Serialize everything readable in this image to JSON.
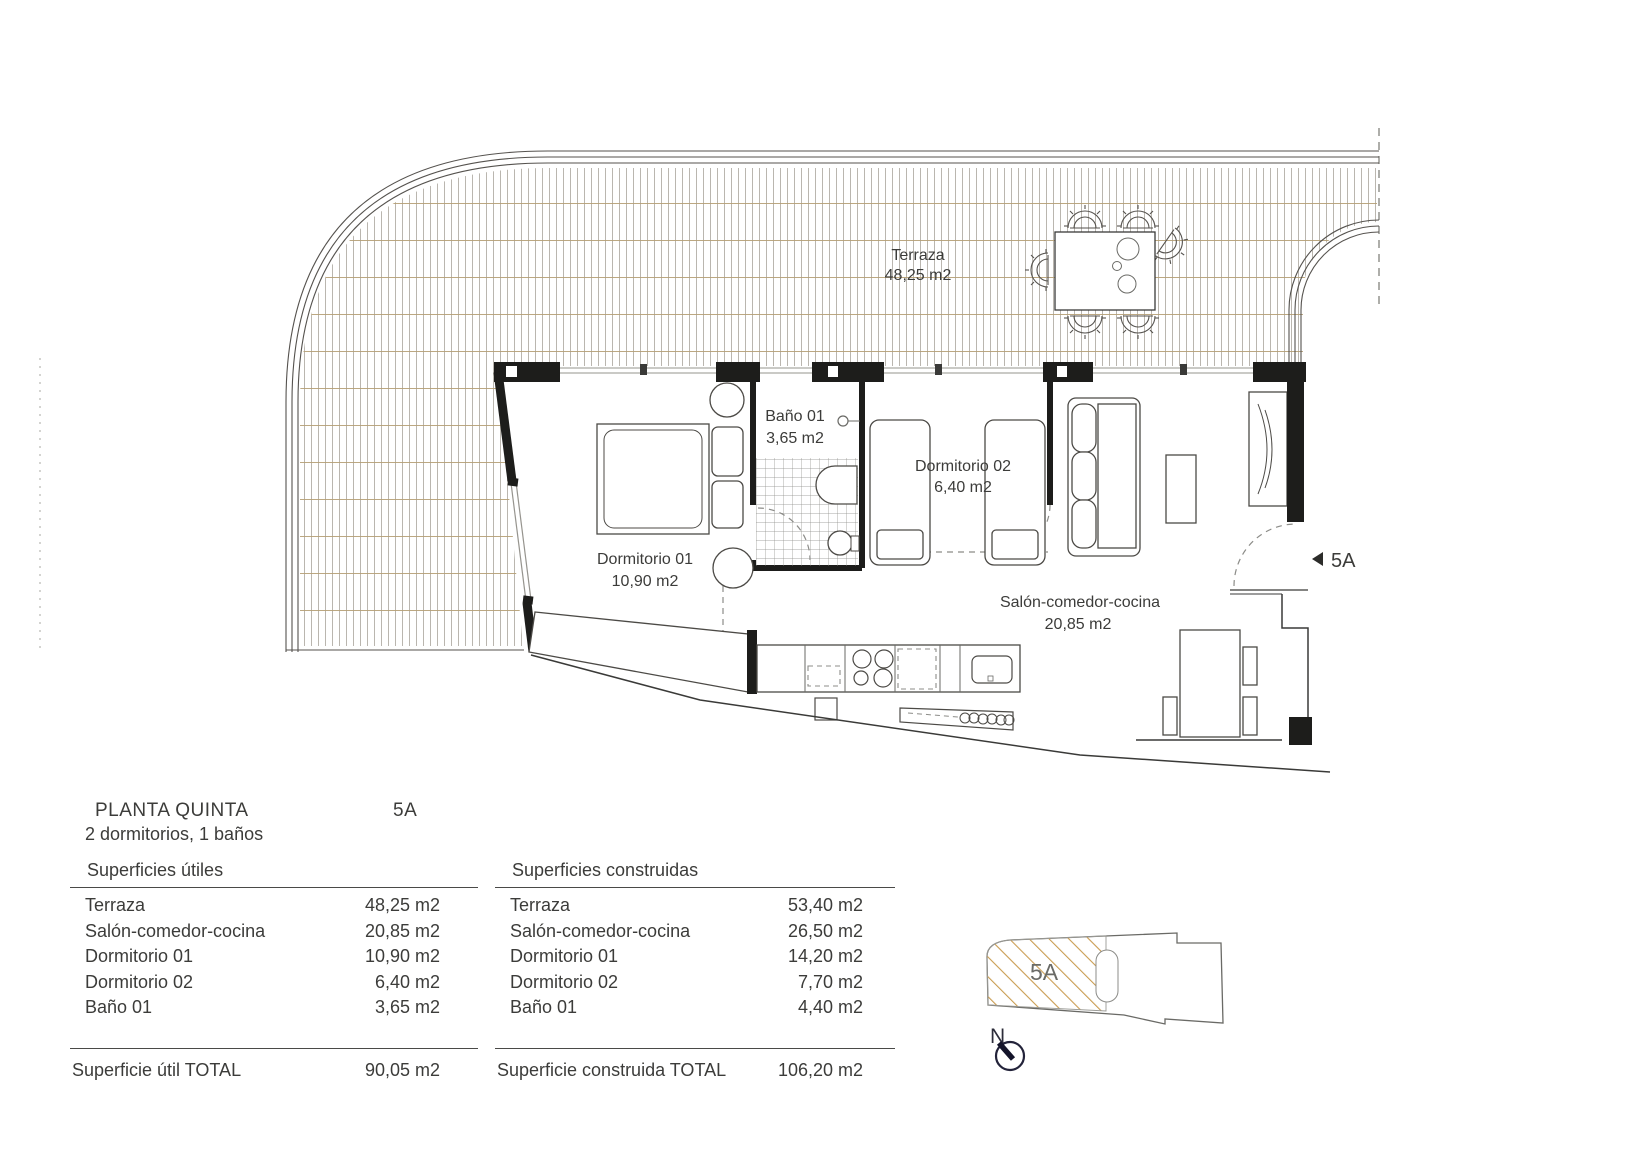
{
  "info": {
    "floor_title": "PLANTA QUINTA",
    "unit": "5A",
    "subtitle": "2 dormitorios, 1 baños"
  },
  "plan": {
    "terrace": {
      "name": "Terraza",
      "area": "48,25 m2"
    },
    "bath": {
      "name": "Baño 01",
      "area": "3,65 m2"
    },
    "bedroom2": {
      "name": "Dormitorio 02",
      "area": "6,40 m2"
    },
    "bedroom1": {
      "name": "Dormitorio 01",
      "area": "10,90 m2"
    },
    "living": {
      "name": "Salón-comedor-cocina",
      "area": "20,85 m2"
    },
    "entrance_marker": "5A"
  },
  "useful_table": {
    "header": "Superficies útiles",
    "rows": [
      {
        "name": "Terraza",
        "value": "48,25 m2"
      },
      {
        "name": "Salón-comedor-cocina",
        "value": "20,85 m2"
      },
      {
        "name": "Dormitorio 01",
        "value": "10,90 m2"
      },
      {
        "name": "Dormitorio 02",
        "value": "6,40 m2"
      },
      {
        "name": "Baño 01",
        "value": "3,65 m2"
      }
    ],
    "total_label": "Superficie útil TOTAL",
    "total_value": "90,05 m2"
  },
  "built_table": {
    "header": "Superficies construidas",
    "rows": [
      {
        "name": "Terraza",
        "value": "53,40 m2"
      },
      {
        "name": "Salón-comedor-cocina",
        "value": "26,50 m2"
      },
      {
        "name": "Dormitorio 01",
        "value": "14,20 m2"
      },
      {
        "name": "Dormitorio 02",
        "value": "7,70 m2"
      },
      {
        "name": "Baño 01",
        "value": "4,40 m2"
      }
    ],
    "total_label": "Superficie construida TOTAL",
    "total_value": "106,20 m2"
  },
  "locator": {
    "unit_label": "5A",
    "north_label": "N"
  },
  "colors": {
    "wall": "#1d1d1b",
    "line": "#4a4a48",
    "text": "#3c3c3a",
    "terrace_vline": "#a8a49b",
    "terrace_hline": "#b49e74",
    "locator_hatch": "#c99c51"
  }
}
